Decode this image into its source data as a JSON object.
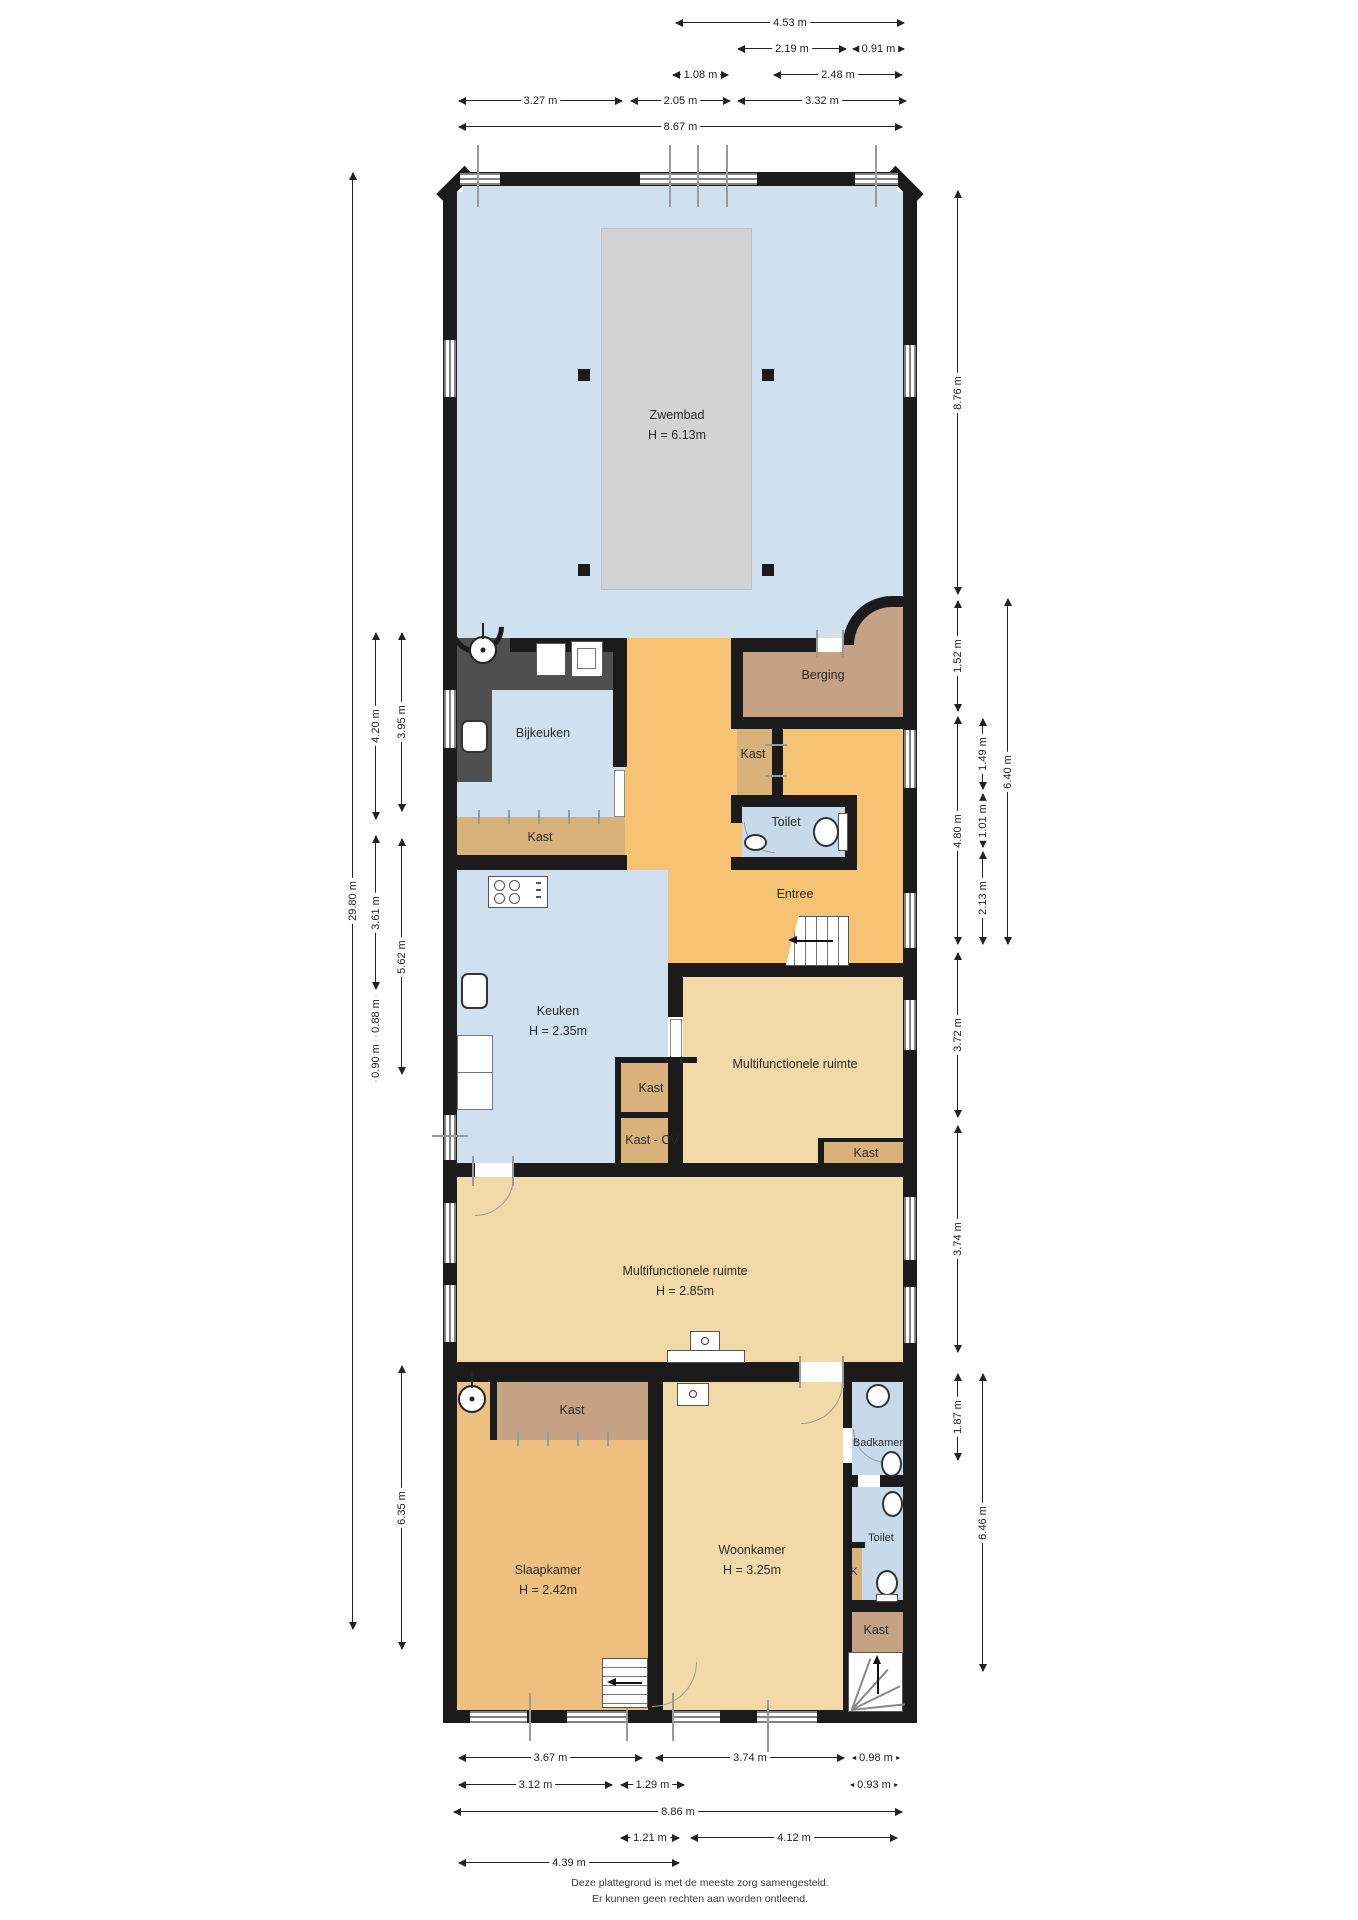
{
  "rooms": {
    "zwembad": {
      "name": "Zwembad",
      "h": "H = 6.13m"
    },
    "berging": {
      "name": "Berging"
    },
    "bijkeuken": {
      "name": "Bijkeuken"
    },
    "kast_bijkeuken": {
      "name": "Kast"
    },
    "kast_entree": {
      "name": "Kast"
    },
    "toilet_entree": {
      "name": "Toilet"
    },
    "entree": {
      "name": "Entree"
    },
    "keuken": {
      "name": "Keuken",
      "h": "H = 2.35m"
    },
    "multifunctionele_1": {
      "name": "Multifunctionele ruimte"
    },
    "kast_keuken": {
      "name": "Kast"
    },
    "kast_cv": {
      "name": "Kast - CV"
    },
    "kast_multi": {
      "name": "Kast"
    },
    "multifunctionele_2": {
      "name": "Multifunctionele ruimte",
      "h": "H = 2.85m"
    },
    "kast_slaapkamer": {
      "name": "Kast"
    },
    "badkamer": {
      "name": "Badkamer"
    },
    "slaapkamer": {
      "name": "Slaapkamer",
      "h": "H = 2.42m"
    },
    "woonkamer": {
      "name": "Woonkamer",
      "h": "H = 3.25m"
    },
    "toilet_onder": {
      "name": "Toilet"
    },
    "k_kast": {
      "name": "K"
    },
    "kast_onder": {
      "name": "Kast"
    }
  },
  "dimensions": {
    "top": [
      "4.53 m",
      "2.19 m",
      "0.91 m",
      "1.08 m",
      "2.48 m",
      "3.27 m",
      "2.05 m",
      "3.32 m",
      "8.67 m"
    ],
    "bottom": [
      "3.67 m",
      "3.74 m",
      "0.98 m",
      "3.12 m",
      "1.29 m",
      "0.93 m",
      "8.86 m",
      "1.21 m",
      "4.12 m",
      "4.39 m"
    ],
    "left": [
      "29.80 m",
      "4.20 m",
      "3.95 m",
      "3.61 m",
      "5.62 m",
      "0.88 m",
      "0.90 m",
      "6.35 m"
    ],
    "right": [
      "8.76 m",
      "1.52 m",
      "1.49 m",
      "6.40 m",
      "1.01 m",
      "4.80 m",
      "2.13 m",
      "3.72 m",
      "3.74 m",
      "1.87 m",
      "6.46 m"
    ]
  },
  "footer": {
    "line1": "Deze plattegrond is met de meeste zorg samengesteld.",
    "line2": "Er kunnen geen rechten aan worden ontleend."
  },
  "icons": [
    "shower-icon",
    "washing-machine-icon",
    "sink-icon",
    "stove-icon",
    "toilet-icon",
    "fireplace-icon",
    "stairs-icon",
    "window",
    "door-swing-arc"
  ],
  "colors": {
    "wall": "#1b1b1b",
    "pool_room": "#cfe0ee",
    "pool": "#d3d3d3",
    "corridor": "#f6c273",
    "closet": "#d9b27b",
    "storage": "#c6a284",
    "living": "#f2d9a8",
    "bedroom": "#eec07f",
    "bathroom": "#c7dae9",
    "counter": "#4f4f4f"
  }
}
